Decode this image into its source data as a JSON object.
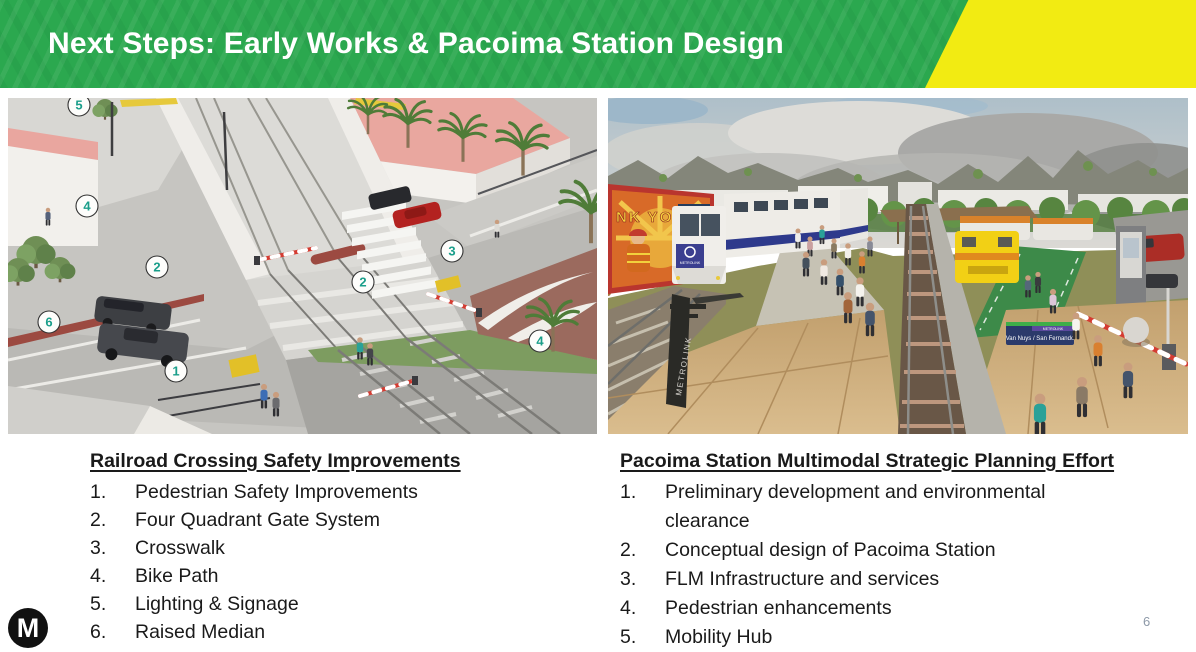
{
  "header": {
    "title": "Next Steps: Early Works & Pacoima Station Design",
    "green": "#2BA84F",
    "yellow": "#F2EB12"
  },
  "left_panel": {
    "image_name": "railroad-crossing-rendering",
    "callouts": [
      "5",
      "4",
      "2",
      "2",
      "6",
      "1",
      "3",
      "4"
    ],
    "list": {
      "heading": "Railroad Crossing Safety Improvements",
      "items": [
        {
          "num": "1.",
          "text": "Pedestrian Safety Improvements"
        },
        {
          "num": "2.",
          "text": "Four Quadrant Gate System"
        },
        {
          "num": "3.",
          "text": "Crosswalk"
        },
        {
          "num": "4.",
          "text": "Bike Path"
        },
        {
          "num": "5.",
          "text": "Lighting & Signage"
        },
        {
          "num": "6.",
          "text": "Raised Median"
        }
      ]
    }
  },
  "right_panel": {
    "image_name": "pacoima-station-rendering",
    "image_text": {
      "mural": "NK YOU",
      "train_logo": "METROLINK",
      "station_sign": "Van Nuys / San Fernando",
      "sign_brand": "METROLINK",
      "pole": "METROLINK"
    },
    "list": {
      "heading": "Pacoima Station Multimodal Strategic Planning Effort",
      "items": [
        {
          "num": "1.",
          "text": "Preliminary development and environmental clearance"
        },
        {
          "num": "2.",
          "text": "Conceptual design of Pacoima Station"
        },
        {
          "num": "3.",
          "text": "FLM Infrastructure and services"
        },
        {
          "num": "4.",
          "text": "Pedestrian enhancements"
        },
        {
          "num": "5.",
          "text": "Mobility Hub"
        }
      ]
    }
  },
  "footer": {
    "logo_letter": "M",
    "page_number": "6"
  }
}
